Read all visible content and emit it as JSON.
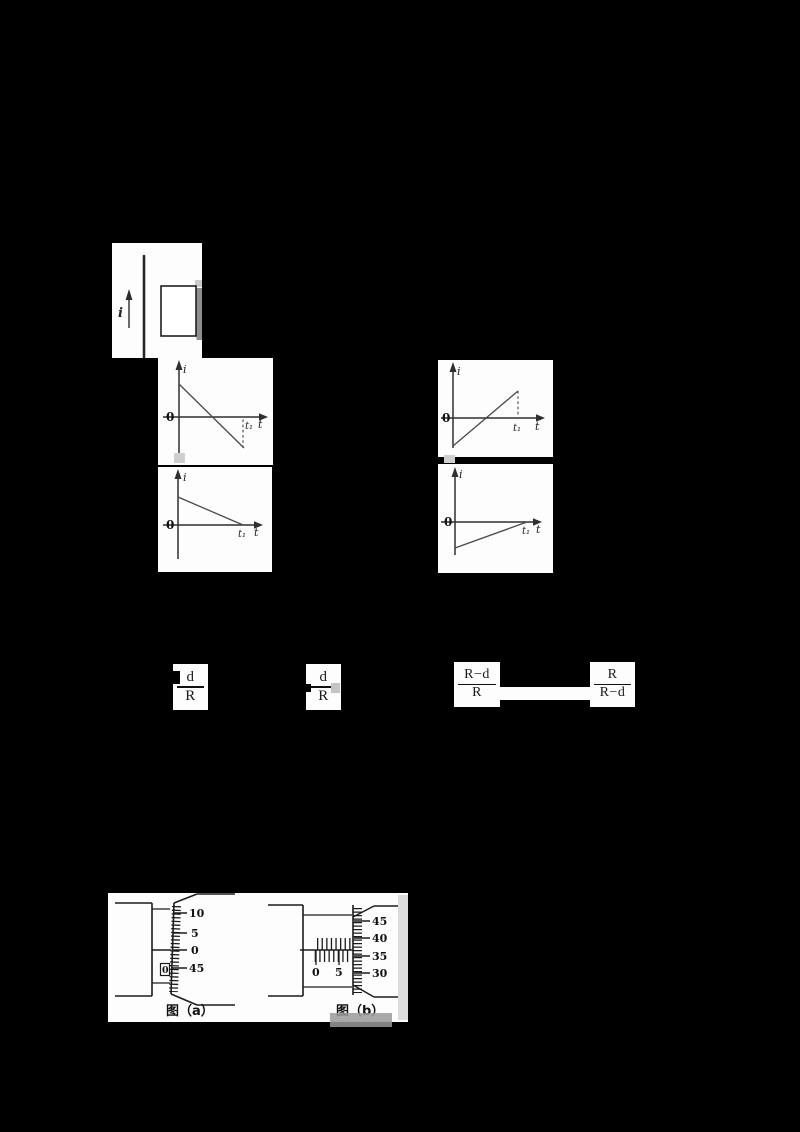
{
  "colors": {
    "page_bg": "#000000",
    "panel_bg": "#fdfdfd",
    "ink": "#2e2e2e",
    "shadow_gray": "#8f8f8f",
    "light_gray": "#cfcfcf"
  },
  "wire_diagram": {
    "current_label": "i"
  },
  "graphs": [
    {
      "y_label": "i",
      "origin_label": "0",
      "t1_label": "t₁",
      "t_label": "t"
    },
    {
      "y_label": "i",
      "origin_label": "0",
      "t1_label": "t₁",
      "t_label": "t"
    },
    {
      "y_label": "i",
      "origin_label": "0",
      "t1_label": "t₁",
      "t_label": "t"
    },
    {
      "y_label": "i",
      "origin_label": "0",
      "t1_label": "t₁",
      "t_label": "t"
    }
  ],
  "chart_data": [
    {
      "type": "line",
      "xlabel": "t",
      "ylabel": "i",
      "x_ticks": [
        "0",
        "t₁"
      ],
      "series": [
        {
          "name": "induced current",
          "trend": "starts at positive maximum at t=0, decreases linearly through zero, ends at negative value at t₁; dashed drop line at t₁"
        }
      ]
    },
    {
      "type": "line",
      "xlabel": "t",
      "ylabel": "i",
      "x_ticks": [
        "0",
        "t₁"
      ],
      "series": [
        {
          "name": "induced current",
          "trend": "starts at negative value at t=0, increases linearly through zero, ends at positive maximum at t₁; dashed drop line at t₁"
        }
      ]
    },
    {
      "type": "line",
      "xlabel": "t",
      "ylabel": "i",
      "x_ticks": [
        "0",
        "t₁"
      ],
      "series": [
        {
          "name": "induced current",
          "trend": "starts at positive value at t=0, decreases linearly to zero at t₁"
        }
      ]
    },
    {
      "type": "line",
      "xlabel": "t",
      "ylabel": "i",
      "x_ticks": [
        "0",
        "t₁"
      ],
      "series": [
        {
          "name": "induced current",
          "trend": "starts at negative value at t=0, increases linearly to zero at t₁"
        }
      ]
    }
  ],
  "options": [
    {
      "numerator": "d",
      "denominator": "R"
    },
    {
      "numerator": "d",
      "denominator": "R"
    },
    {
      "numerator": "R−d",
      "denominator": "R"
    },
    {
      "numerator": "R",
      "denominator": "R−d"
    }
  ],
  "micrometers": {
    "a": {
      "caption": "图（a）",
      "thimble_labels": [
        "10",
        "5",
        "0",
        "45"
      ],
      "sleeve_label": "0"
    },
    "b": {
      "caption": "图（b）",
      "main_scale_labels": [
        "0",
        "5"
      ],
      "thimble_labels": [
        "45",
        "40",
        "35",
        "30"
      ]
    }
  }
}
